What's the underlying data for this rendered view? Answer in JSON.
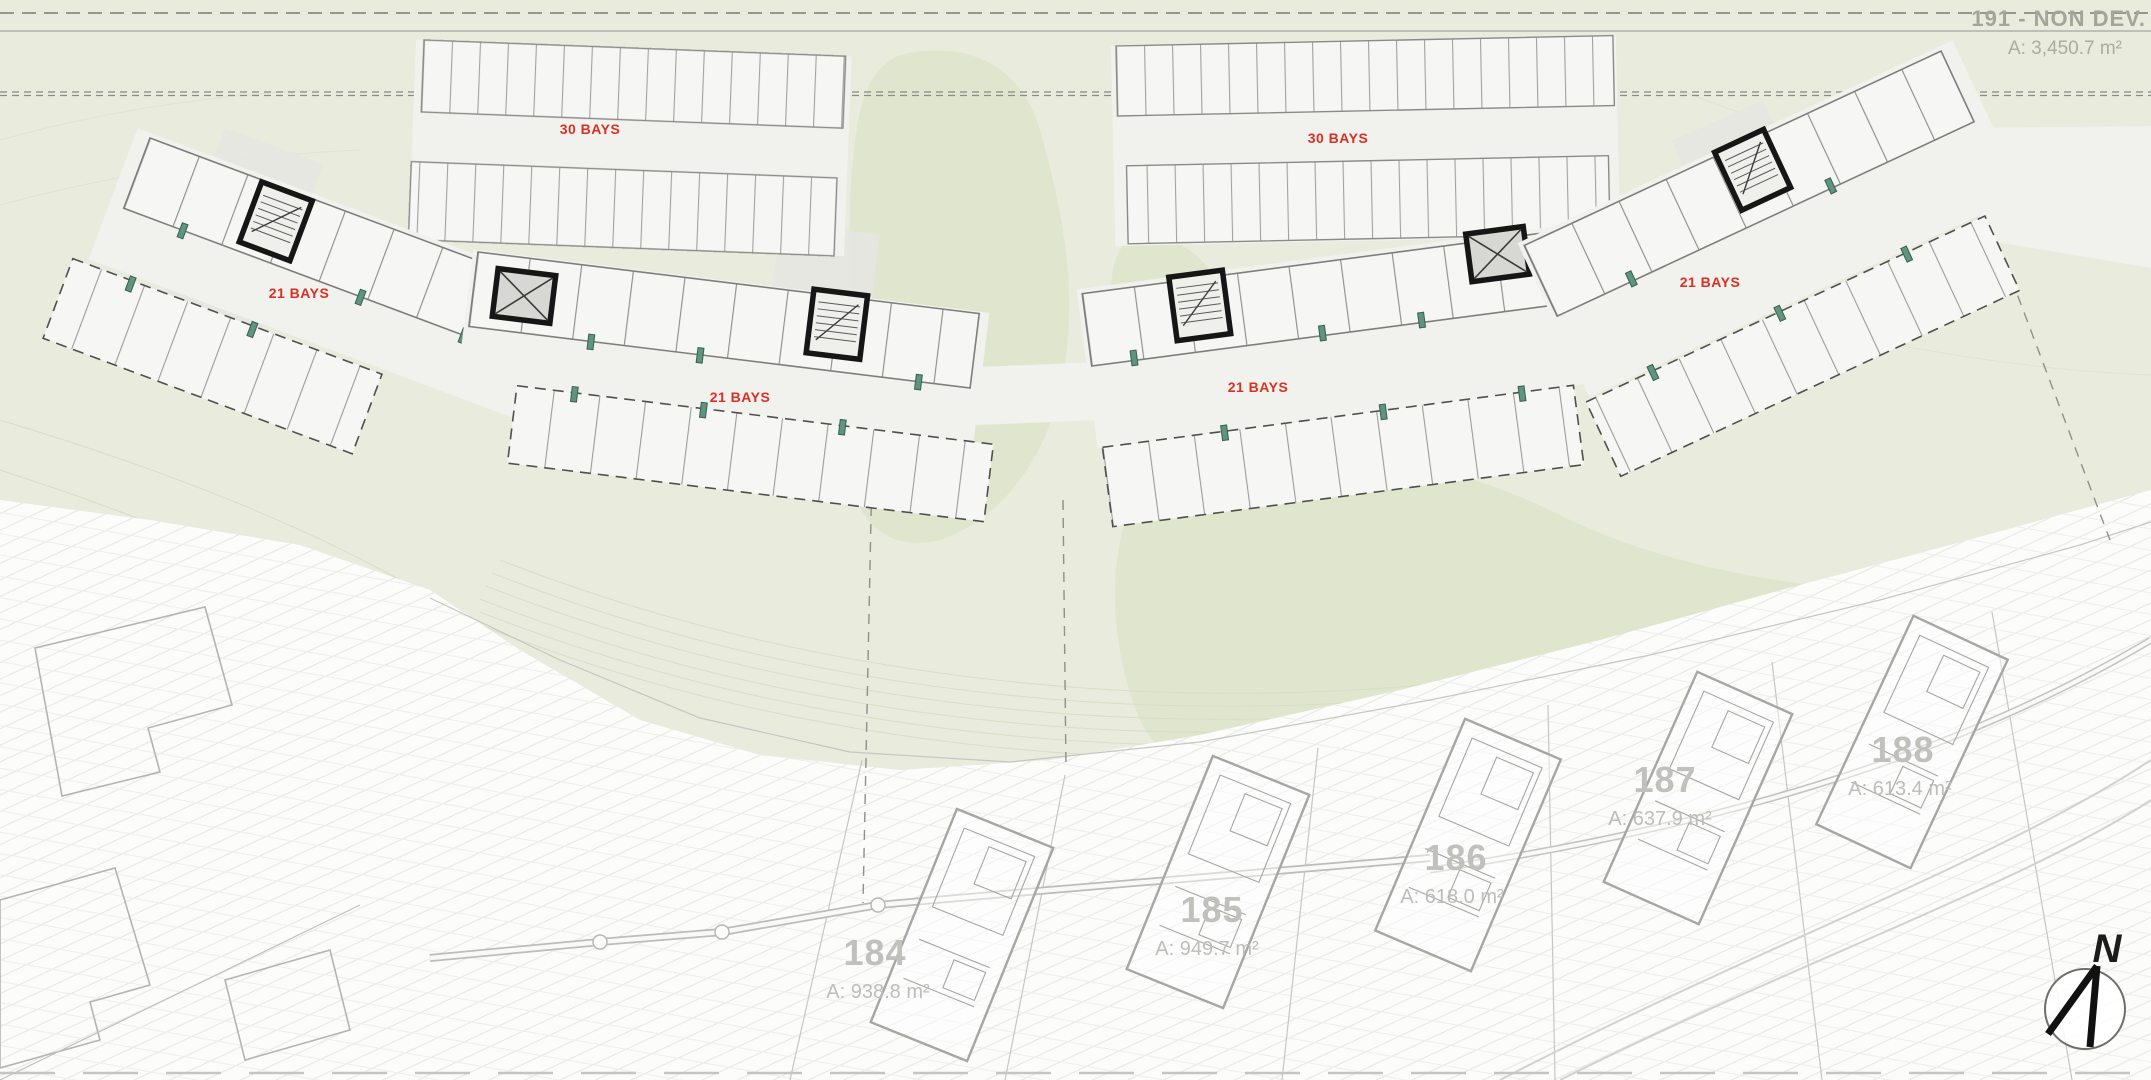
{
  "plan": {
    "non_dev_parcel": {
      "title": "191 - NON DEV.",
      "area": "A: 3,450.7 m²"
    },
    "hidden_parcel": {
      "number": "191",
      "area_partial": "A: 10,0",
      "number_partial": "30"
    },
    "parking": {
      "top_left_label": "30 BAYS",
      "top_right_label": "30 BAYS",
      "wing_left_label": "21 BAYS",
      "wing_mid_left_label": "21 BAYS",
      "wing_mid_right_label": "21 BAYS",
      "wing_right_label": "21 BAYS"
    },
    "plots": [
      {
        "number": "184",
        "area": "A: 938.8 m²"
      },
      {
        "number": "185",
        "area": "A: 949.7 m²"
      },
      {
        "number": "186",
        "area": "A: 618.0 m²"
      },
      {
        "number": "187",
        "area": "A: 637.9 m²"
      },
      {
        "number": "188",
        "area": "A: 613.4 m²"
      }
    ],
    "compass": {
      "label": "N"
    },
    "colors": {
      "terrain_green": "#e9ebdd",
      "terrain_green_dark": "#dfe6cd",
      "terrain_white": "#fcfcfb",
      "road_white": "#f1f1ee",
      "building_fill": "#f6f6f4",
      "building_stroke": "#90908e",
      "stair_core_black": "#161616",
      "door_marker_green": "#5f957e",
      "bays_label_red": "#d93025",
      "plot_label_gray": "#c0c0bd"
    }
  }
}
